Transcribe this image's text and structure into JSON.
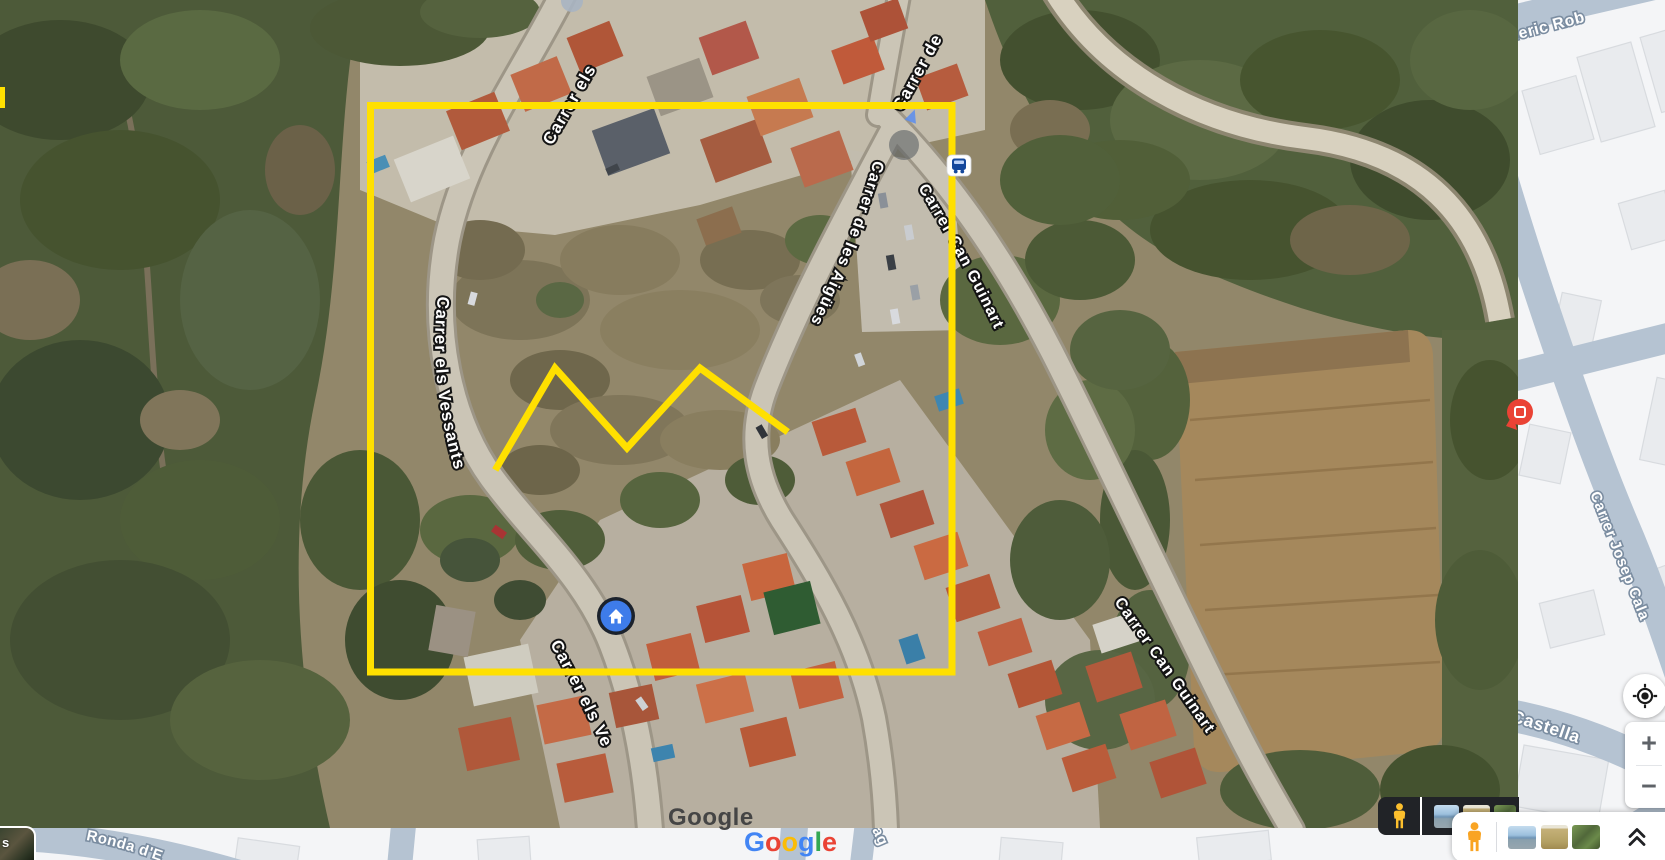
{
  "app_title": "Google Maps",
  "view": {
    "mode": "satellite",
    "width": 1665,
    "height": 860
  },
  "satellite": {
    "street_labels": [
      {
        "id": "carrer-els",
        "text": "Carrer els"
      },
      {
        "id": "carrer-de",
        "text": "Carrer de"
      },
      {
        "id": "can-guinart-top",
        "text": "Carrer Can Guinart"
      },
      {
        "id": "aigues",
        "text": "Carrer de les Aigües"
      },
      {
        "id": "vessants",
        "text": "Carrer els Vessants"
      },
      {
        "id": "vessants-bottom",
        "text": "Carrer els Ve"
      },
      {
        "id": "can-guinart-bottom",
        "text": "Carrer Can Guinart"
      }
    ],
    "watermark": "Google"
  },
  "basemap": {
    "street_labels": [
      {
        "id": "roderic",
        "text": "oderic Rob"
      },
      {
        "id": "josep",
        "text": "Carrer Josep Cala"
      },
      {
        "id": "castella",
        "text": "r Castella"
      },
      {
        "id": "ronda",
        "text": "Ronda d'E"
      },
      {
        "id": "street-fragment",
        "text": "ag"
      }
    ],
    "road_color": "#b5c3d2",
    "background": "#f4f5f7",
    "building_color": "#e9ebee"
  },
  "annotations": {
    "color": "#FFE000",
    "rectangle": {
      "x": 370.5,
      "y": 105.5,
      "width": 581.5,
      "height": 566.5,
      "stroke_width": 7
    },
    "polyline_points": "497,467 555,368 627,448 700,368 785,430",
    "edge_tick": {
      "x": 0,
      "y": 87,
      "width": 5,
      "height": 21
    }
  },
  "markers": {
    "home": {
      "fill": "#3E7CEA",
      "ring": "#1B222C"
    },
    "red_poi": {
      "fill": "#EA4335"
    },
    "bus_stop": {
      "fill": "#15489C"
    }
  },
  "icons": {
    "my_location": "target-crosshair",
    "zoom_in": "plus",
    "zoom_out": "minus",
    "collapse": "double-chevron-up",
    "pegman": "street-view-person",
    "home_marker": "house",
    "bus_stop": "bus",
    "red_poi": "place-pin"
  },
  "controls": {
    "zoom_in_label": "+",
    "zoom_out_label": "−",
    "layers_partial_label": "s"
  },
  "carousel": {
    "thumbnails": [
      "coastline-photo",
      "field-photo",
      "vegetation-photo"
    ]
  },
  "brand_logo": {
    "letters": [
      "G",
      "o",
      "o",
      "g",
      "l",
      "e"
    ],
    "colors": [
      "#4285F4",
      "#EA4335",
      "#FBBC05",
      "#4285F4",
      "#34A853",
      "#EA4335"
    ]
  }
}
